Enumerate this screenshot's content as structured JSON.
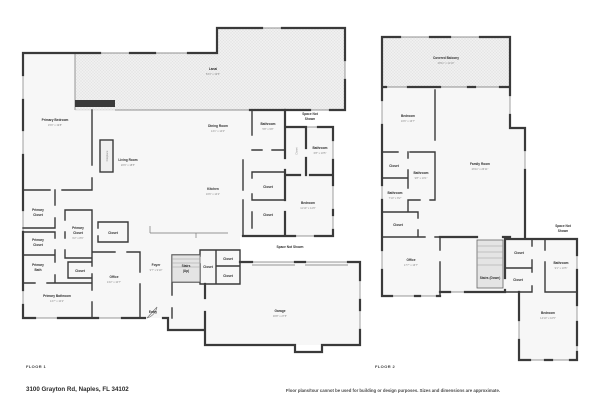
{
  "floor1": {
    "label": "FLOOR 1",
    "rooms": {
      "lanai": {
        "name": "Lanai",
        "dims": "53'3\" x 19'5\""
      },
      "primary_bedroom": {
        "name": "Primary Bedroom",
        "dims": "15'0\" x 19'8\""
      },
      "living_room": {
        "name": "Living Room",
        "dims": "20'9\" x 18'5\""
      },
      "fireplace": {
        "name": "Fireplace"
      },
      "dining_room": {
        "name": "Dining Room",
        "dims": "14'1\" x 14'0\""
      },
      "bathroom": {
        "name": "Bathroom",
        "dims": "5'8\" x 9'8\""
      },
      "space_not_shown_top": {
        "line1": "Space Not",
        "line2": "Shown"
      },
      "closet_hall": {
        "name": "Closet"
      },
      "bathroom2": {
        "name": "Bathroom",
        "dims": "6'8\" x 10'5\""
      },
      "bedroom": {
        "name": "Bedroom",
        "dims": "11'10\" x 14'6\""
      },
      "kitchen": {
        "name": "Kitchen",
        "dims": "16'6\" x 14'2\""
      },
      "closet_a": {
        "name": "Closet"
      },
      "closet_b": {
        "name": "Closet"
      },
      "primary_closet_1": {
        "line1": "Primary",
        "line2": "Closet"
      },
      "primary_closet_2": {
        "line1": "Primary",
        "line2": "Closet"
      },
      "primary_bath": {
        "line1": "Primary",
        "line2": "Bath"
      },
      "primary_closet_3": {
        "line1": "Primary",
        "line2": "Closet",
        "dims": "6'2\" x 8'9\""
      },
      "closet_c": {
        "name": "Closet"
      },
      "closet_d": {
        "name": "Closet"
      },
      "office": {
        "name": "Office",
        "dims": "13'2\" x 10'7\""
      },
      "primary_bathroom": {
        "name": "Primary Bathroom",
        "dims": "14'7\" x 10'2\""
      },
      "foyer": {
        "name": "Foyer",
        "dims": "9'7\" x 9'10\""
      },
      "stairs_up": {
        "line1": "Stairs",
        "line2": "(Up)"
      },
      "closet_e": {
        "name": "Closet"
      },
      "closet_f": {
        "name": "Closet"
      },
      "closet_g": {
        "name": "Closet"
      },
      "entry": {
        "name": "Entry"
      },
      "space_not_shown_mid": {
        "name": "Space Not Shown"
      },
      "garage": {
        "name": "Garage",
        "dims": "30'8\" x 27'5\""
      }
    }
  },
  "floor2": {
    "label": "FLOOR 2",
    "rooms": {
      "covered_balcony": {
        "name": "Covered Balcony",
        "dims": "28'11\" x 11'10\""
      },
      "bedroom_a": {
        "name": "Bedroom",
        "dims": "16'6\" x 16'7\""
      },
      "closet_h": {
        "name": "Closet"
      },
      "bathroom_a": {
        "name": "Bathroom",
        "dims": "9'8\" x 10'1\""
      },
      "bathroom_b": {
        "name": "Bathroom",
        "dims": "7'10\" x 8'2\""
      },
      "closet_i": {
        "name": "Closet"
      },
      "family_room": {
        "name": "Family Room",
        "dims": "26'11\" x 26'11\""
      },
      "office": {
        "name": "Office",
        "dims": "17'7\" x 16'7\""
      },
      "stairs_down": {
        "name": "Stairs (Down)"
      },
      "closet_j": {
        "name": "Closet"
      },
      "closet_k": {
        "name": "Closet"
      },
      "space_not_shown": {
        "line1": "Space Not",
        "line2": "Shown"
      },
      "bathroom_c": {
        "name": "Bathroom",
        "dims": "9'1\" x 10'5\""
      },
      "bedroom_b": {
        "name": "Bedroom",
        "dims": "14'10\" x 16'5\""
      }
    }
  },
  "footer": {
    "address": "3100 Grayton Rd, Naples, FL 34102",
    "disclaimer": "Floor plans/tour cannot be used for building or design purposes. Sizes and dimensions are approximate."
  }
}
